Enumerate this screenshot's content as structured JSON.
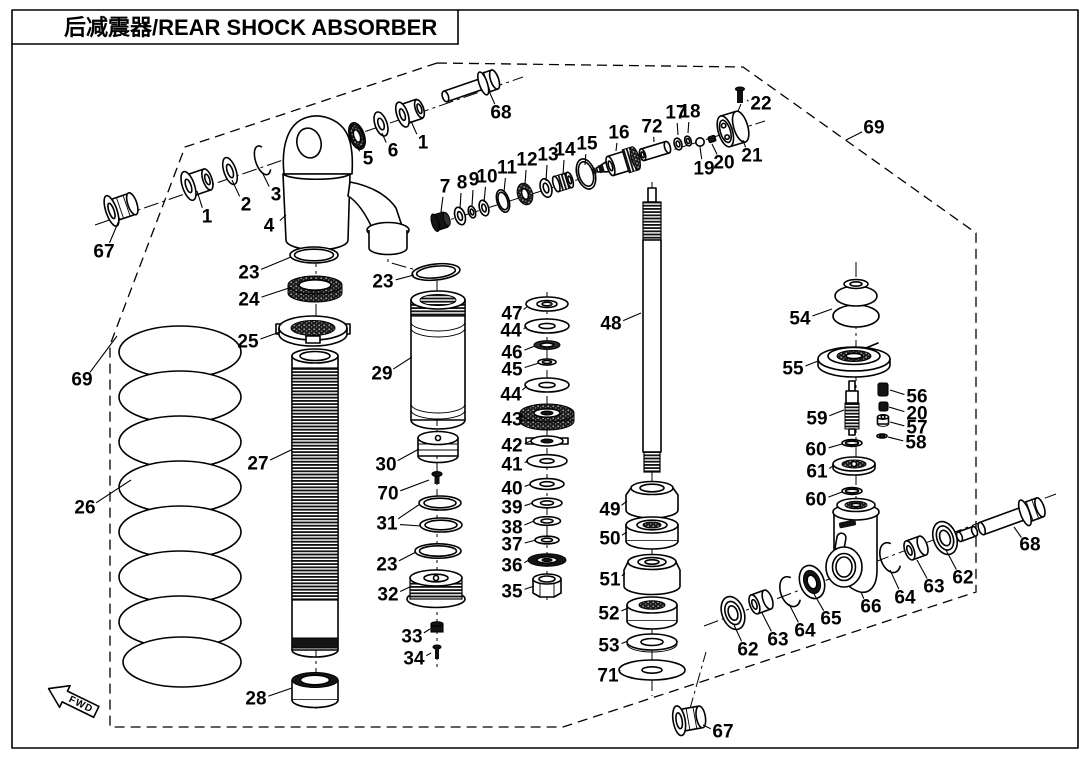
{
  "title": "后减震器/REAR SHOCK ABSORBER",
  "fwd_label": "FWD",
  "colors": {
    "ink": "#000000",
    "paper": "#ffffff"
  },
  "callouts": [
    {
      "label": "67",
      "x": 104,
      "y": 252,
      "tx": 120,
      "ty": 218
    },
    {
      "label": "1",
      "x": 207,
      "y": 217,
      "tx": 197,
      "ty": 191
    },
    {
      "label": "2",
      "x": 246,
      "y": 205,
      "tx": 232,
      "ty": 180
    },
    {
      "label": "3",
      "x": 276,
      "y": 195,
      "tx": 262,
      "ty": 172
    },
    {
      "label": "4",
      "x": 269,
      "y": 226,
      "tx": 286,
      "ty": 215
    },
    {
      "label": "5",
      "x": 368,
      "y": 159,
      "tx": 357,
      "ty": 146
    },
    {
      "label": "6",
      "x": 393,
      "y": 151,
      "tx": 382,
      "ty": 133
    },
    {
      "label": "1",
      "x": 423,
      "y": 143,
      "tx": 411,
      "ty": 121
    },
    {
      "label": "68",
      "x": 501,
      "y": 113,
      "tx": 489,
      "ty": 91
    },
    {
      "label": "23",
      "x": 249,
      "y": 273,
      "tx": 291,
      "ty": 257
    },
    {
      "label": "24",
      "x": 249,
      "y": 300,
      "tx": 289,
      "ty": 288
    },
    {
      "label": "25",
      "x": 248,
      "y": 342,
      "tx": 280,
      "ty": 332
    },
    {
      "label": "69",
      "x": 82,
      "y": 380,
      "tx": 117,
      "ty": 336
    },
    {
      "label": "26",
      "x": 85,
      "y": 508,
      "tx": 131,
      "ty": 480
    },
    {
      "label": "27",
      "x": 258,
      "y": 464,
      "tx": 291,
      "ty": 450
    },
    {
      "label": "28",
      "x": 256,
      "y": 699,
      "tx": 292,
      "ty": 688
    },
    {
      "label": "23",
      "x": 383,
      "y": 282,
      "tx": 414,
      "ty": 275
    },
    {
      "label": "29",
      "x": 382,
      "y": 374,
      "tx": 412,
      "ty": 357
    },
    {
      "label": "30",
      "x": 386,
      "y": 465,
      "tx": 419,
      "ty": 449
    },
    {
      "label": "70",
      "x": 388,
      "y": 494,
      "tx": 429,
      "ty": 480
    },
    {
      "label": "31",
      "x": 387,
      "y": 524,
      "tx": 420,
      "ty": 504,
      "tx2": 421,
      "ty2": 526
    },
    {
      "label": "23",
      "x": 387,
      "y": 565,
      "tx": 416,
      "ty": 552
    },
    {
      "label": "32",
      "x": 388,
      "y": 595,
      "tx": 412,
      "ty": 586
    },
    {
      "label": "33",
      "x": 412,
      "y": 637,
      "tx": 430,
      "ty": 629
    },
    {
      "label": "34",
      "x": 414,
      "y": 659,
      "tx": 431,
      "ty": 653
    },
    {
      "label": "47",
      "x": 512,
      "y": 314,
      "tx": 528,
      "ty": 306
    },
    {
      "label": "44",
      "x": 511,
      "y": 331,
      "tx": 527,
      "ty": 327
    },
    {
      "label": "46",
      "x": 512,
      "y": 353,
      "tx": 535,
      "ty": 346
    },
    {
      "label": "45",
      "x": 512,
      "y": 370,
      "tx": 539,
      "ty": 363
    },
    {
      "label": "44",
      "x": 511,
      "y": 395,
      "tx": 527,
      "ty": 386
    },
    {
      "label": "43",
      "x": 512,
      "y": 420,
      "tx": 522,
      "ty": 414
    },
    {
      "label": "42",
      "x": 512,
      "y": 446,
      "tx": 531,
      "ty": 441
    },
    {
      "label": "41",
      "x": 512,
      "y": 465,
      "tx": 528,
      "ty": 461
    },
    {
      "label": "40",
      "x": 512,
      "y": 489,
      "tx": 531,
      "ty": 484
    },
    {
      "label": "39",
      "x": 512,
      "y": 508,
      "tx": 533,
      "ty": 503
    },
    {
      "label": "38",
      "x": 512,
      "y": 528,
      "tx": 534,
      "ty": 521
    },
    {
      "label": "37",
      "x": 512,
      "y": 545,
      "tx": 536,
      "ty": 540
    },
    {
      "label": "36",
      "x": 512,
      "y": 566,
      "tx": 529,
      "ty": 560
    },
    {
      "label": "35",
      "x": 512,
      "y": 592,
      "tx": 534,
      "ty": 586
    },
    {
      "label": "48",
      "x": 611,
      "y": 324,
      "tx": 641,
      "ty": 313
    },
    {
      "label": "49",
      "x": 610,
      "y": 510,
      "tx": 627,
      "ty": 501
    },
    {
      "label": "50",
      "x": 610,
      "y": 539,
      "tx": 627,
      "ty": 532
    },
    {
      "label": "51",
      "x": 610,
      "y": 580,
      "tx": 625,
      "ty": 573
    },
    {
      "label": "52",
      "x": 609,
      "y": 614,
      "tx": 628,
      "ty": 608
    },
    {
      "label": "53",
      "x": 609,
      "y": 646,
      "tx": 628,
      "ty": 641
    },
    {
      "label": "71",
      "x": 608,
      "y": 676,
      "tx": 620,
      "ty": 670
    },
    {
      "label": "7",
      "x": 445,
      "y": 187,
      "tx": 441,
      "ty": 212
    },
    {
      "label": "8",
      "x": 462,
      "y": 183,
      "tx": 460,
      "ty": 209
    },
    {
      "label": "9",
      "x": 474,
      "y": 180,
      "tx": 472,
      "ty": 206
    },
    {
      "label": "10",
      "x": 487,
      "y": 177,
      "tx": 484,
      "ty": 202
    },
    {
      "label": "11",
      "x": 507,
      "y": 168,
      "tx": 504,
      "ty": 192
    },
    {
      "label": "12",
      "x": 527,
      "y": 160,
      "tx": 525,
      "ty": 185
    },
    {
      "label": "13",
      "x": 548,
      "y": 155,
      "tx": 546,
      "ty": 181
    },
    {
      "label": "14",
      "x": 565,
      "y": 150,
      "tx": 563,
      "ty": 175
    },
    {
      "label": "15",
      "x": 587,
      "y": 144,
      "tx": 585,
      "ty": 165
    },
    {
      "label": "16",
      "x": 619,
      "y": 133,
      "tx": 616,
      "ty": 151
    },
    {
      "label": "72",
      "x": 652,
      "y": 127,
      "tx": 654,
      "ty": 142
    },
    {
      "label": "17",
      "x": 676,
      "y": 113,
      "tx": 678,
      "ty": 135
    },
    {
      "label": "18",
      "x": 690,
      "y": 112,
      "tx": 688,
      "ty": 133
    },
    {
      "label": "19",
      "x": 704,
      "y": 169,
      "tx": 700,
      "ty": 147
    },
    {
      "label": "20",
      "x": 724,
      "y": 163,
      "tx": 712,
      "ty": 144
    },
    {
      "label": "21",
      "x": 752,
      "y": 156,
      "tx": 743,
      "ty": 140
    },
    {
      "label": "22",
      "x": 761,
      "y": 104,
      "tx": 747,
      "ty": 100
    },
    {
      "label": "69",
      "x": 874,
      "y": 128,
      "tx": 846,
      "ty": 140
    },
    {
      "label": "54",
      "x": 800,
      "y": 319,
      "tx": 832,
      "ty": 309
    },
    {
      "label": "55",
      "x": 793,
      "y": 369,
      "tx": 818,
      "ty": 361
    },
    {
      "label": "59",
      "x": 817,
      "y": 419,
      "tx": 844,
      "ty": 410
    },
    {
      "label": "56",
      "x": 917,
      "y": 397,
      "tx": 890,
      "ty": 390
    },
    {
      "label": "20",
      "x": 917,
      "y": 414,
      "tx": 889,
      "ty": 407
    },
    {
      "label": "57",
      "x": 917,
      "y": 428,
      "tx": 890,
      "ty": 422
    },
    {
      "label": "58",
      "x": 916,
      "y": 443,
      "tx": 888,
      "ty": 437
    },
    {
      "label": "60",
      "x": 816,
      "y": 450,
      "tx": 842,
      "ty": 444
    },
    {
      "label": "61",
      "x": 817,
      "y": 472,
      "tx": 833,
      "ty": 466
    },
    {
      "label": "60",
      "x": 816,
      "y": 500,
      "tx": 842,
      "ty": 492
    },
    {
      "label": "66",
      "x": 871,
      "y": 607,
      "tx": 861,
      "ty": 592
    },
    {
      "label": "65",
      "x": 831,
      "y": 619,
      "tx": 814,
      "ty": 594
    },
    {
      "label": "64",
      "x": 805,
      "y": 631,
      "tx": 789,
      "ty": 604
    },
    {
      "label": "63",
      "x": 778,
      "y": 640,
      "tx": 762,
      "ty": 613
    },
    {
      "label": "62",
      "x": 748,
      "y": 650,
      "tx": 734,
      "ty": 625
    },
    {
      "label": "64",
      "x": 905,
      "y": 598,
      "tx": 890,
      "ty": 570
    },
    {
      "label": "63",
      "x": 934,
      "y": 587,
      "tx": 917,
      "ty": 560
    },
    {
      "label": "62",
      "x": 963,
      "y": 578,
      "tx": 946,
      "ty": 550
    },
    {
      "label": "68",
      "x": 1030,
      "y": 545,
      "tx": 1014,
      "ty": 527
    },
    {
      "label": "67",
      "x": 723,
      "y": 732,
      "tx": 703,
      "ty": 725
    }
  ]
}
